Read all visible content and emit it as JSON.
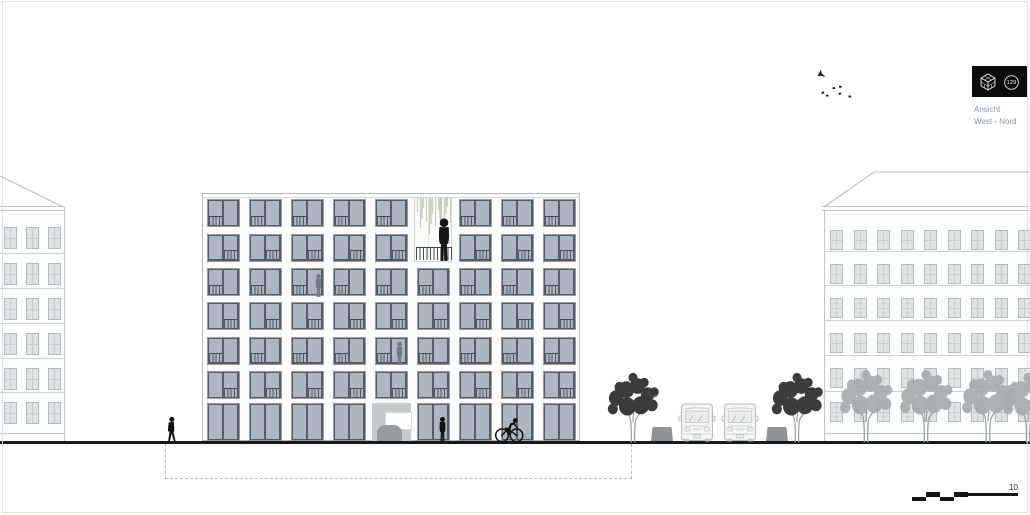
{
  "annotation": {
    "view_label_line1": "Ansicht",
    "view_label_line2": "West - Nord",
    "badge_number": "129",
    "scale_label": "10",
    "badge_icon": "wireframe-cube-icon"
  },
  "colors": {
    "background": "#ffffff",
    "window_glass": "#acb6c0",
    "window_frame": "#545d67",
    "neighbor_window": "#e0e3e4",
    "facade": "#fcfdfd",
    "ground_line": "#191919",
    "basement_dash": "#b5b9bc",
    "label_text": "#8b95a1",
    "title_block_bg": "#0b0b0b",
    "plant_green": "#c8d1b7",
    "tree_dark": "#2d2d2d",
    "tree_light": "#a8acae",
    "car_outline": "#b4b8bb",
    "bin_gray": "#8e9295"
  },
  "buildings": {
    "main": {
      "window_columns": 9,
      "upper_floors": 6,
      "ground_floor": 1,
      "loggia_column_index": 5,
      "loggia_floors": 2,
      "entrance_column_index": 4
    },
    "left_neighbor": {
      "window_columns": 3,
      "window_rows": 6
    },
    "right_neighbor": {
      "window_columns": 9,
      "window_rows": 6
    }
  },
  "street": {
    "dark_trees": 2,
    "light_trees": 4,
    "cars": 2,
    "bins": 2,
    "pedestrians_ground": 2,
    "people_in_windows": 2,
    "person_on_balcony": 1,
    "cyclists": 1,
    "birds": 7
  }
}
